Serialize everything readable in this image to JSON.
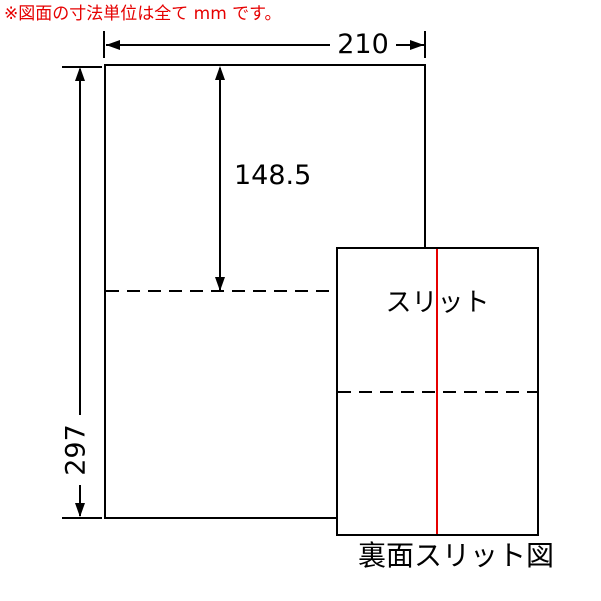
{
  "note": {
    "text": "※図面の寸法単位は全て mm です。"
  },
  "dimensions": {
    "width_mm": "210",
    "height_mm": "297",
    "half_height_mm": "148.5"
  },
  "back_view": {
    "slit_label": "スリット",
    "caption": "裏面スリット図"
  },
  "colors": {
    "line_black": "#000000",
    "slit_red": "#e60000",
    "note_red": "#e60000",
    "background": "#ffffff"
  }
}
